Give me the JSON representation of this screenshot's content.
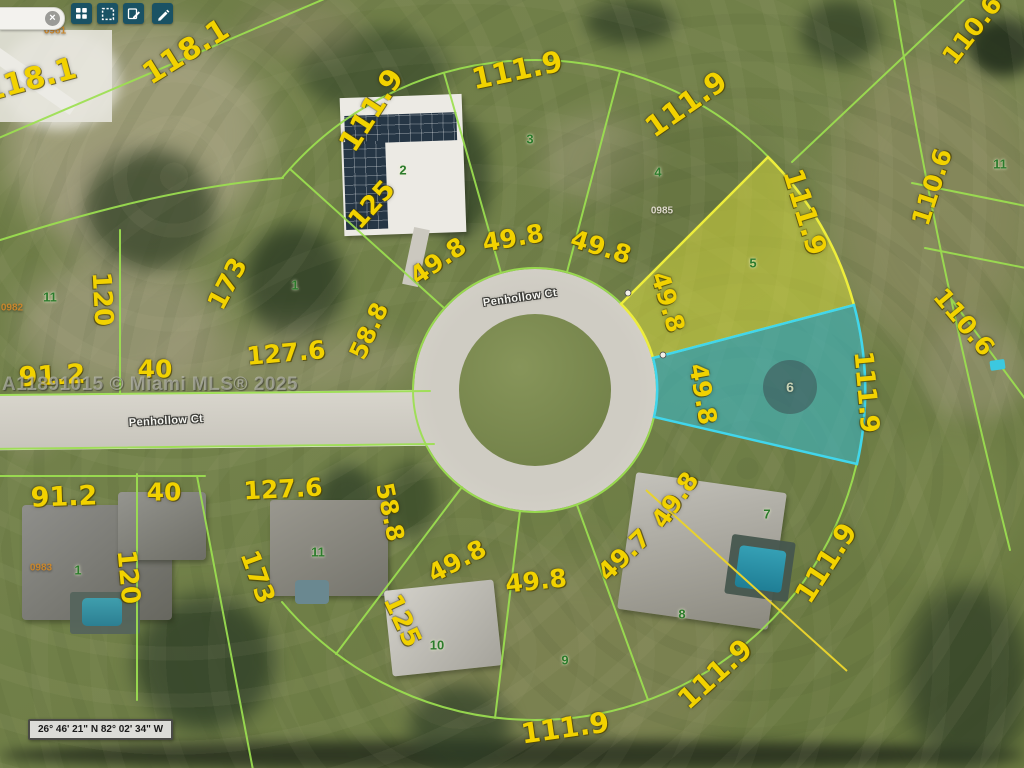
{
  "app": {
    "toolbar": {
      "buttons": [
        {
          "name": "grid-view"
        },
        {
          "name": "select-area"
        },
        {
          "name": "edit-notes"
        },
        {
          "name": "measure"
        }
      ],
      "clear_icon": "×"
    },
    "watermark": "A11891015 © Miami MLS® 2025",
    "coordinates_bar": "26° 46' 21\" N 82° 02' 34\" W"
  },
  "map": {
    "colors": {
      "line": "#9ce050",
      "l5f": "rgba(225,228,60,0.48)",
      "l5s": "#eded3c",
      "l6f": "rgba(52,188,208,0.55)",
      "l6s": "#41d6ec",
      "yellow": "#e8d22e",
      "dim": "#f2d200",
      "lot": "#2c7a2c",
      "pid": "#c9862c",
      "street": "#f5f5f0",
      "btn": "#1a5264"
    },
    "street_labels": [
      {
        "t": "Penhollow Ct",
        "x": 520,
        "y": 298,
        "r": -8
      },
      {
        "t": "Penhollow Ct",
        "x": 166,
        "y": 421,
        "r": -3
      }
    ],
    "parcel_ids": [
      {
        "t": "0981",
        "x": 55,
        "y": 31
      },
      {
        "t": "0982",
        "x": 12,
        "y": 308
      },
      {
        "t": "0983",
        "x": 41,
        "y": 568
      },
      {
        "t": "0985",
        "x": 662,
        "y": 211,
        "light": true
      }
    ],
    "lot_numbers": [
      {
        "t": "11",
        "x": 50,
        "y": 297
      },
      {
        "t": "1",
        "x": 295,
        "y": 285
      },
      {
        "t": "2",
        "x": 403,
        "y": 170
      },
      {
        "t": "3",
        "x": 530,
        "y": 139
      },
      {
        "t": "4",
        "x": 658,
        "y": 172
      },
      {
        "t": "5",
        "x": 753,
        "y": 263
      },
      {
        "t": "11",
        "x": 1000,
        "y": 164
      },
      {
        "t": "6",
        "x": 790,
        "y": 387,
        "light": true
      },
      {
        "t": "7",
        "x": 767,
        "y": 514
      },
      {
        "t": "8",
        "x": 682,
        "y": 614
      },
      {
        "t": "9",
        "x": 565,
        "y": 660
      },
      {
        "t": "10",
        "x": 437,
        "y": 645
      },
      {
        "t": "11",
        "x": 318,
        "y": 552
      },
      {
        "t": "1",
        "x": 78,
        "y": 570
      }
    ],
    "dimension_labels": [
      {
        "t": "118.1",
        "x": 30,
        "y": 80,
        "r": -15,
        "s": 30
      },
      {
        "t": "118.1",
        "x": 186,
        "y": 52,
        "r": -32,
        "s": 30
      },
      {
        "t": "111.9",
        "x": 371,
        "y": 110,
        "r": -57,
        "s": 29
      },
      {
        "t": "111.9",
        "x": 517,
        "y": 70,
        "r": -12,
        "s": 29
      },
      {
        "t": "111.9",
        "x": 686,
        "y": 104,
        "r": -35,
        "s": 29
      },
      {
        "t": "111.9",
        "x": 805,
        "y": 212,
        "r": 73,
        "s": 28
      },
      {
        "t": "110.6",
        "x": 972,
        "y": 30,
        "r": -52,
        "s": 25
      },
      {
        "t": "110.6",
        "x": 932,
        "y": 187,
        "r": -72,
        "s": 25
      },
      {
        "t": "110.6",
        "x": 964,
        "y": 322,
        "r": 50,
        "s": 25
      },
      {
        "t": "125",
        "x": 372,
        "y": 205,
        "r": -48,
        "s": 26
      },
      {
        "t": "49.8",
        "x": 438,
        "y": 261,
        "r": -35,
        "s": 25
      },
      {
        "t": "49.8",
        "x": 513,
        "y": 238,
        "r": -10,
        "s": 25
      },
      {
        "t": "49.8",
        "x": 601,
        "y": 247,
        "r": 17,
        "s": 25
      },
      {
        "t": "49.8",
        "x": 668,
        "y": 302,
        "r": 73,
        "s": 25
      },
      {
        "t": "173",
        "x": 228,
        "y": 284,
        "r": -62,
        "s": 26
      },
      {
        "t": "120",
        "x": 102,
        "y": 299,
        "r": 87,
        "s": 26
      },
      {
        "t": "58.8",
        "x": 369,
        "y": 331,
        "r": -65,
        "s": 24
      },
      {
        "t": "127.6",
        "x": 286,
        "y": 353,
        "r": -5,
        "s": 25
      },
      {
        "t": "40",
        "x": 155,
        "y": 369,
        "r": 0,
        "s": 25
      },
      {
        "t": "91.2",
        "x": 52,
        "y": 376,
        "r": -3,
        "s": 27
      },
      {
        "t": "49.8",
        "x": 703,
        "y": 394,
        "r": 80,
        "s": 25
      },
      {
        "t": "111.9",
        "x": 866,
        "y": 392,
        "r": 85,
        "s": 26
      },
      {
        "t": "91.2",
        "x": 64,
        "y": 497,
        "r": -2,
        "s": 27
      },
      {
        "t": "40",
        "x": 164,
        "y": 492,
        "r": 0,
        "s": 25
      },
      {
        "t": "127.6",
        "x": 283,
        "y": 489,
        "r": -3,
        "s": 25
      },
      {
        "t": "120",
        "x": 128,
        "y": 577,
        "r": 85,
        "s": 26
      },
      {
        "t": "173",
        "x": 257,
        "y": 577,
        "r": 70,
        "s": 26
      },
      {
        "t": "58.8",
        "x": 390,
        "y": 512,
        "r": 78,
        "s": 24
      },
      {
        "t": "125",
        "x": 402,
        "y": 621,
        "r": 65,
        "s": 26
      },
      {
        "t": "49.8",
        "x": 457,
        "y": 561,
        "r": -28,
        "s": 25
      },
      {
        "t": "49.8",
        "x": 536,
        "y": 581,
        "r": -6,
        "s": 25
      },
      {
        "t": "49.7",
        "x": 624,
        "y": 555,
        "r": -44,
        "s": 25
      },
      {
        "t": "49.8",
        "x": 675,
        "y": 500,
        "r": -55,
        "s": 25
      },
      {
        "t": "111.9",
        "x": 826,
        "y": 563,
        "r": -57,
        "s": 28
      },
      {
        "t": "111.9",
        "x": 715,
        "y": 674,
        "r": -42,
        "s": 28
      },
      {
        "t": "111.9",
        "x": 565,
        "y": 728,
        "r": -8,
        "s": 28
      }
    ]
  }
}
